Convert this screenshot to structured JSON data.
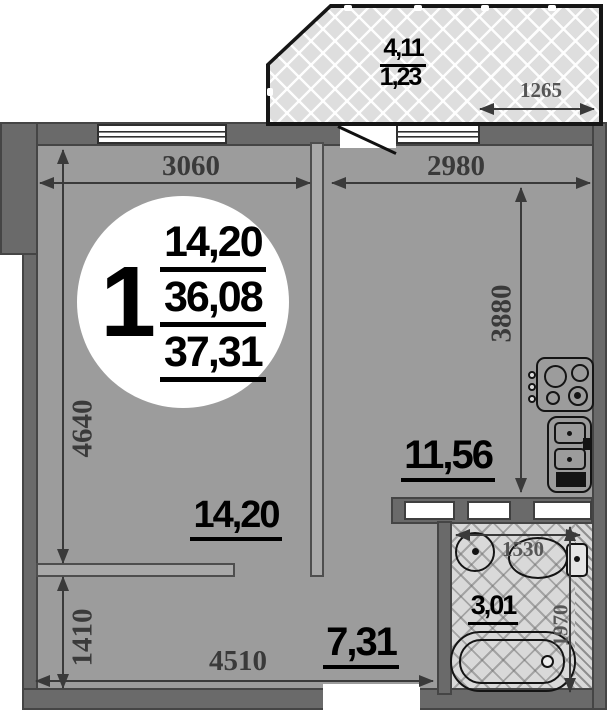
{
  "badge": {
    "rooms_count": "1",
    "living_area": "14,20",
    "total_area": "36,08",
    "overall_area": "37,31"
  },
  "rooms": {
    "living": {
      "area": "14,20"
    },
    "kitchen": {
      "area": "11,56"
    },
    "hallway": {
      "area": "7,31"
    },
    "bathroom": {
      "area": "3,01"
    },
    "balcony": {
      "area_full": "4,11",
      "area_reduced": "1,23"
    }
  },
  "dimensions": {
    "living_width": "3060",
    "living_height": "4640",
    "kitchen_width": "2980",
    "kitchen_height": "3880",
    "balcony_width": "1265",
    "bathroom_width": "1530",
    "bathroom_height": "1970",
    "hallway_height": "1410",
    "hallway_width": "4510"
  },
  "colors": {
    "wall": "#6a6a6a",
    "room_fill": "#9c9c9c",
    "tile_fill": "#d9d9d9",
    "dimension_line": "#3a3a3a",
    "fixture_outline": "#141414",
    "background": "#ffffff"
  }
}
